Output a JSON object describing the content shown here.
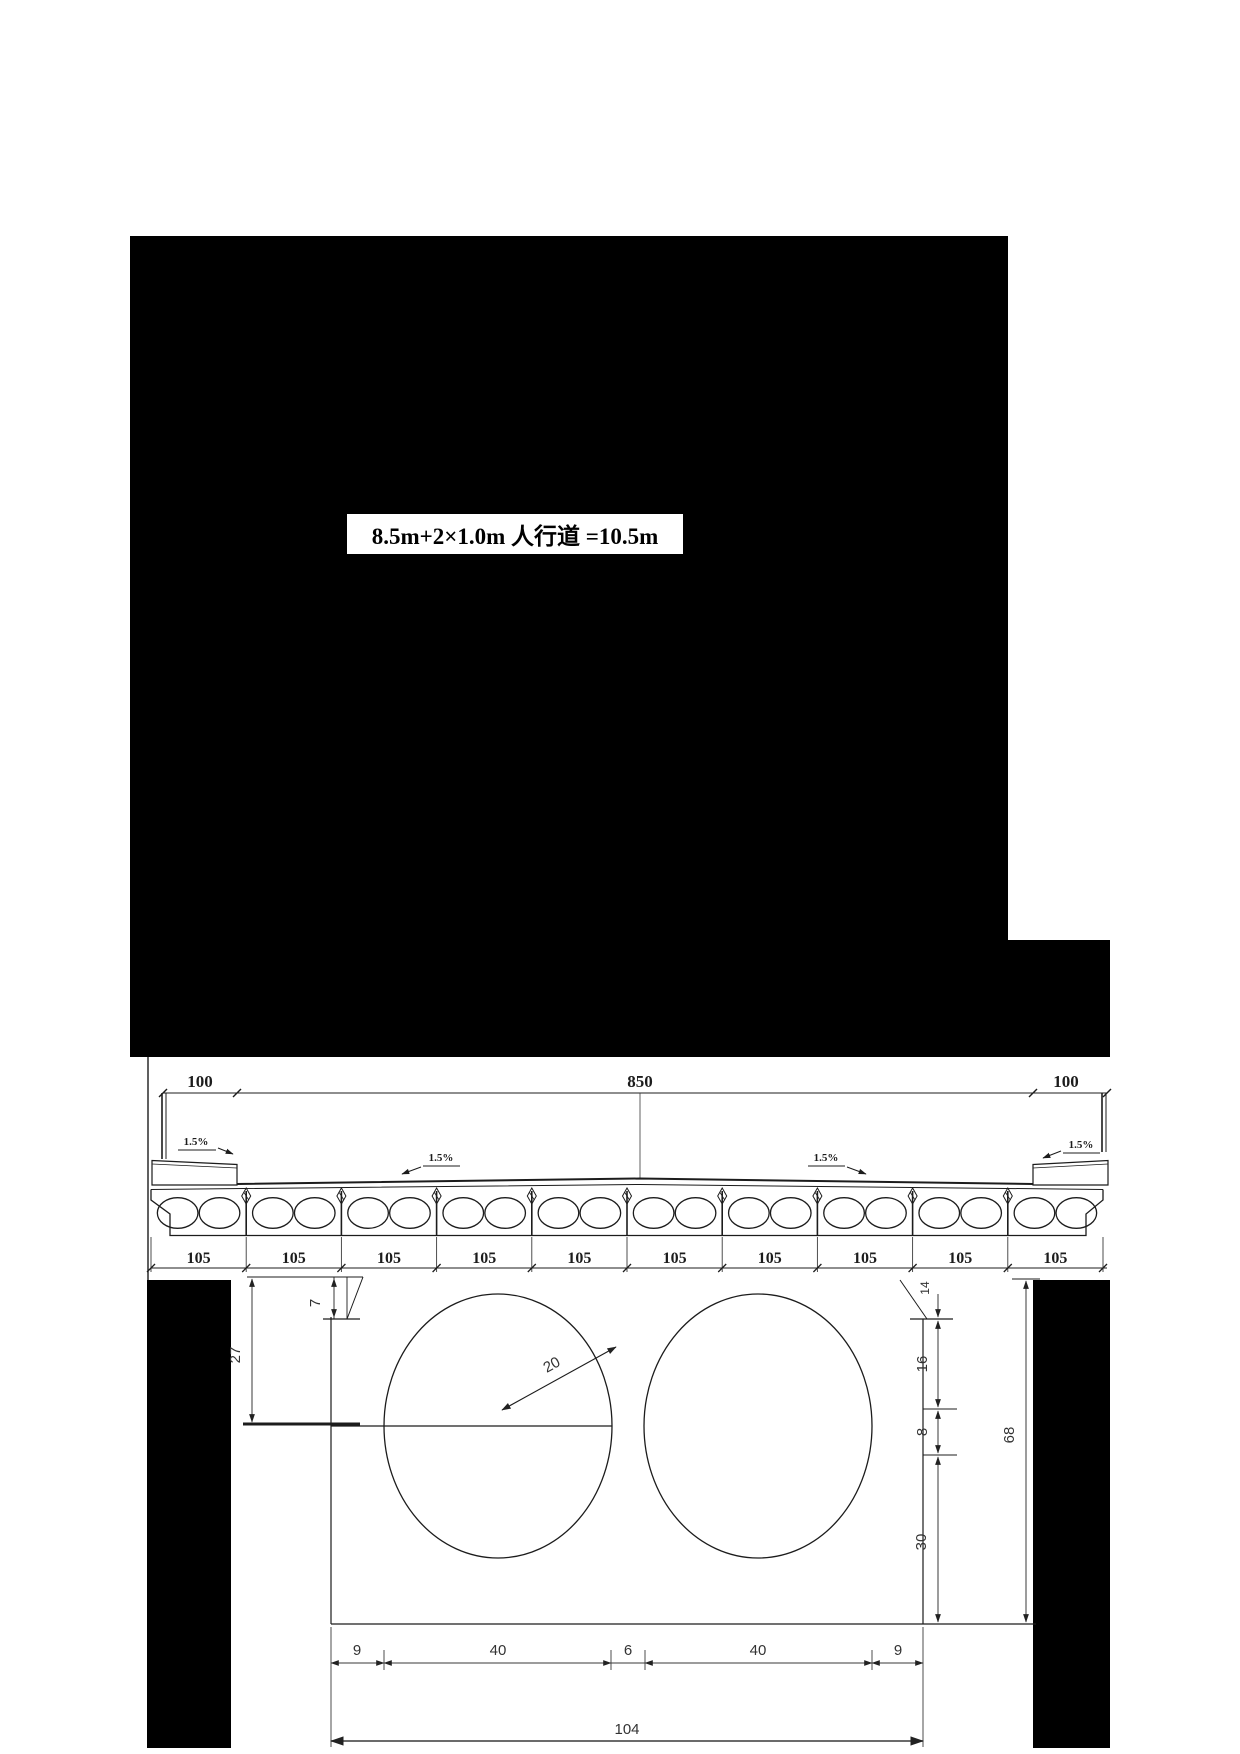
{
  "figure": {
    "top_label": "8.5m+2×1.0m 人行道 =10.5m"
  },
  "cross_section": {
    "dims_top": [
      "100",
      "850",
      "100"
    ],
    "slopes": [
      {
        "label": "1.5%"
      },
      {
        "label": "1.5%"
      },
      {
        "label": "1.5%"
      },
      {
        "label": "1.5%"
      }
    ],
    "beam_count": 10,
    "beam_dims": [
      "105",
      "105",
      "105",
      "105",
      "105",
      "105",
      "105",
      "105",
      "105",
      "105"
    ]
  },
  "detail": {
    "dim_top_drop": "7",
    "dim_to_center": "27",
    "dim_radius": "20",
    "dim_right_top": "14",
    "dim_right_upper": "16",
    "dim_right_key": "8",
    "dim_right_lower": "30",
    "dim_total_height": "68",
    "dims_bottom": [
      "9",
      "40",
      "6",
      "40",
      "9"
    ],
    "dim_total_width": "104"
  },
  "colors": {
    "ink": "#1c1c1c",
    "panel_black": "#000000",
    "paper": "#ffffff"
  }
}
